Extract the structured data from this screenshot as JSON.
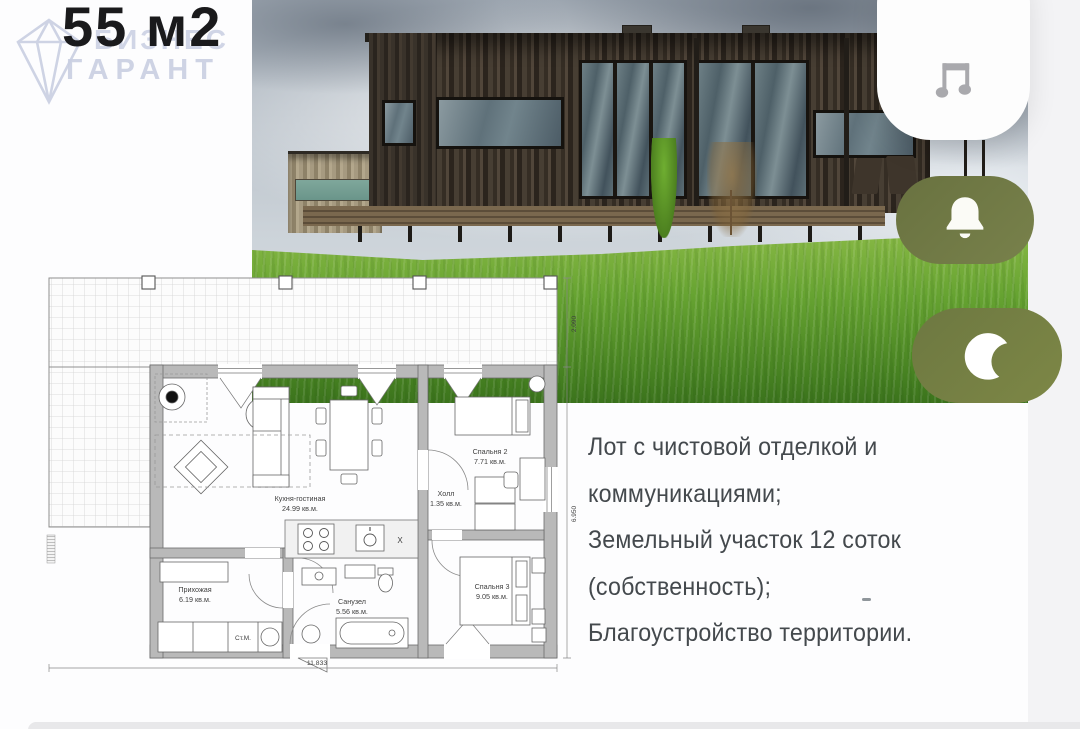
{
  "header": {
    "area_title": "55 м2"
  },
  "watermark": {
    "brand_top": "БИЗНЕС",
    "brand_bottom": "ГАРАНТ"
  },
  "icons": {
    "music": "music-note-icon",
    "bell": "bell-icon",
    "moon": "crescent-moon-icon"
  },
  "description": {
    "lines": [
      "Лот с чистовой отделкой и коммуникациями;",
      "Земельный участок 12 соток (собственность);",
      "Благоустройство территории."
    ]
  },
  "floor_plan": {
    "rooms": [
      {
        "name": "Кухня-гостиная",
        "area": "24.99 кв.м."
      },
      {
        "name": "Спальня 2",
        "area": "7.71 кв.м."
      },
      {
        "name": "Холл",
        "area": "1.35 кв.м."
      },
      {
        "name": "Спальня 3",
        "area": "9.05 кв.м."
      },
      {
        "name": "Прихожая",
        "area": "6.19 кв.м."
      },
      {
        "name": "Санузел",
        "area": "5.56 кв.м."
      }
    ],
    "appliance_labels": {
      "washing_machine": "Ст.М.",
      "kitchen_x": "Х"
    },
    "dimensions": {
      "overall_width": "11.833",
      "overall_depth": "6.950",
      "terrace_depth": "2.090"
    }
  },
  "colors": {
    "accent_olive": "#6e7843",
    "watermark": "#c9cfe2",
    "text": "#44494d",
    "title": "#1a1a1c"
  }
}
